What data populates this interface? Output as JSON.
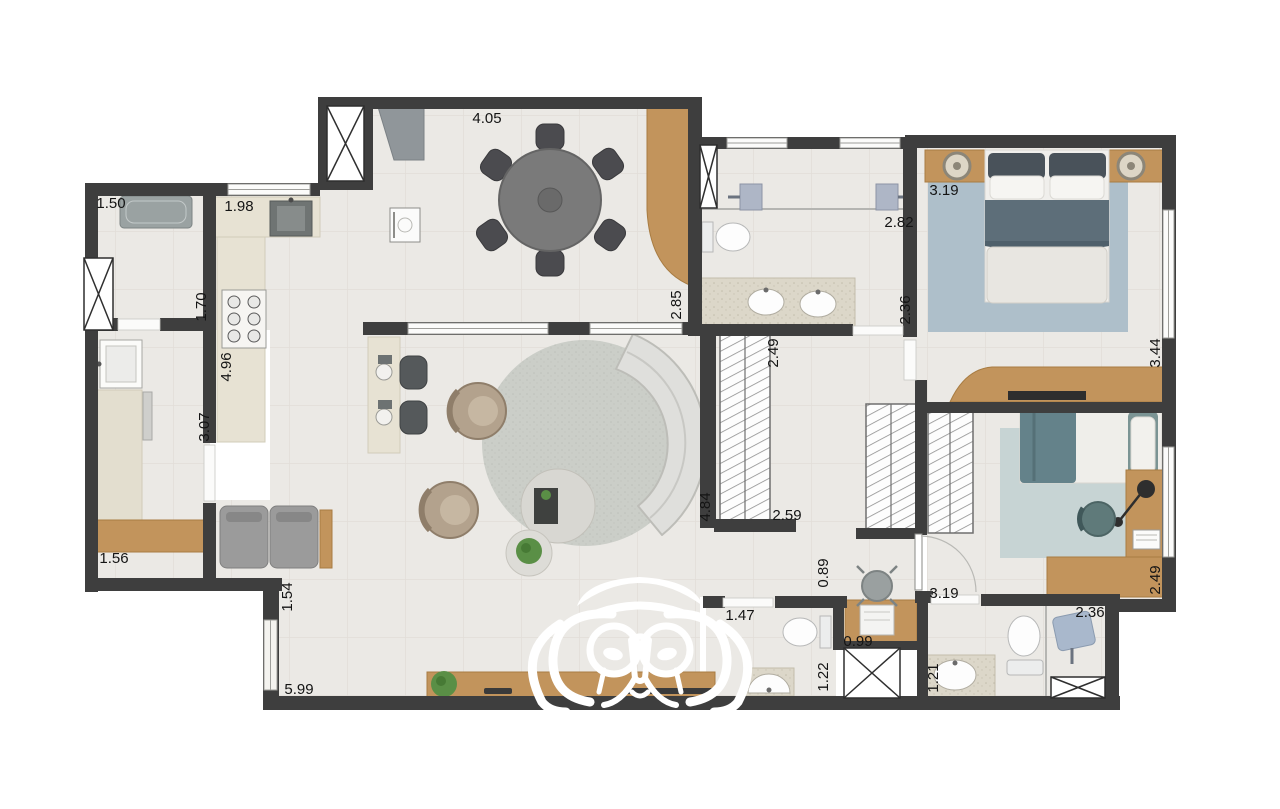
{
  "plan": {
    "type": "apartment-floor-plan",
    "watermark": "tiger-face-watermark",
    "colors": {
      "wall": "#3e3e3e",
      "floor": "#ebe9e5",
      "wood": "#c2945c",
      "granite": "#d9d4c6",
      "sofa": "#dfdfdc",
      "armchair": "#b3a28d",
      "dining_table": "#787878",
      "master_rug": "#aebfca",
      "master_blanket": "#5d6e79",
      "bed2_rug": "#c7d4d4",
      "bed2_blanket": "#64828a",
      "living_rug": "#cbcec8"
    },
    "dimensions": {
      "dining_width": "4.05",
      "service_room_width": "1.50",
      "kitchen_top_width": "1.98",
      "kitchen_passage_depth": "1.70",
      "kitchen_counter_length": "4.96",
      "service_length": "3.07",
      "bench_width": "1.56",
      "balcony_side": "1.54",
      "living_width": "5.99",
      "dining_depth": "2.85",
      "bath1_width": "2.82",
      "bath1_depth": "2.36",
      "master_width": "3.19",
      "master_depth": "3.44",
      "closet_depth": "2.49",
      "hall_length": "4.84",
      "hall_width": "2.59",
      "nook_depth": "0.89",
      "lavabo_width": "1.47",
      "desk_width": "0.99",
      "lavabo_depth": "1.22",
      "bath2_vanity_width": "1.21",
      "bath2_width": "2.36",
      "bed2_width": "3.19",
      "bed2_window_depth": "2.49"
    }
  }
}
